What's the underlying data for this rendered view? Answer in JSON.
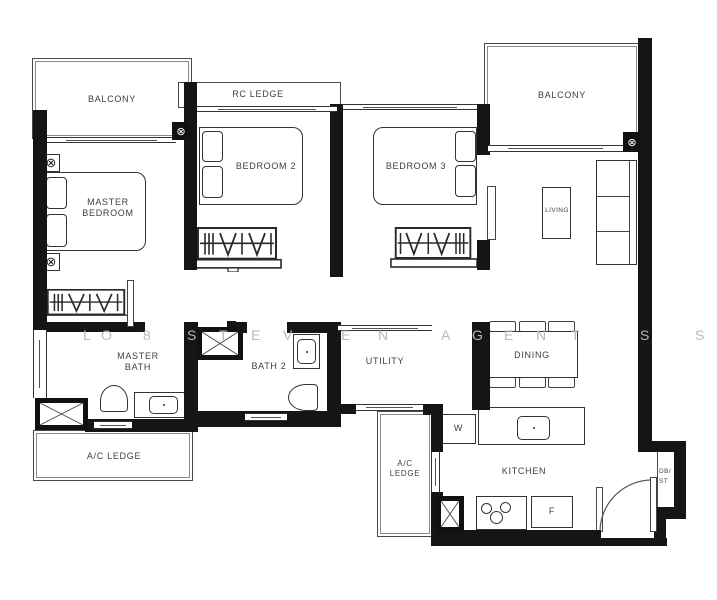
{
  "plan": {
    "title": "3-bedroom condominium unit floor plan",
    "colors": {
      "wall": "#151515",
      "thin_line": "#4a4a4a",
      "label": "#3f3f3f",
      "watermark": "#b9b9b9"
    }
  },
  "labels": {
    "balcony_left": "BALCONY",
    "balcony_right": "BALCONY",
    "rc_ledge": "RC LEDGE",
    "master_bedroom": "MASTER BEDROOM",
    "bedroom2": "BEDROOM 2",
    "bedroom3": "BEDROOM 3",
    "living": "LIVING",
    "dining": "DINING",
    "utility": "UTILITY",
    "master_bath": "MASTER BATH",
    "bath2": "BATH 2",
    "kitchen": "KITCHEN",
    "ac_ledge_left": "A/C LEDGE",
    "ac_ledge_mid": "A/C LEDGE",
    "db_st": "DB/ ST",
    "washer": "W",
    "fridge": "F"
  },
  "symbols": {
    "junction_box": "⊗",
    "nightstand_lamp": "⊗"
  },
  "watermark": {
    "letters": [
      {
        "ch": "L",
        "x": 83
      },
      {
        "ch": "O",
        "x": 101
      },
      {
        "ch": "8",
        "x": 143
      },
      {
        "ch": "S",
        "x": 187
      },
      {
        "ch": "T",
        "x": 219
      },
      {
        "ch": "E",
        "x": 251
      },
      {
        "ch": "V",
        "x": 283
      },
      {
        "ch": "E",
        "x": 341
      },
      {
        "ch": "N",
        "x": 378
      },
      {
        "ch": "A",
        "x": 441
      },
      {
        "ch": "G",
        "x": 472
      },
      {
        "ch": "E",
        "x": 504
      },
      {
        "ch": "N",
        "x": 536
      },
      {
        "ch": "T",
        "x": 571
      },
      {
        "ch": "S",
        "x": 640
      },
      {
        "ch": "S",
        "x": 695
      }
    ]
  }
}
